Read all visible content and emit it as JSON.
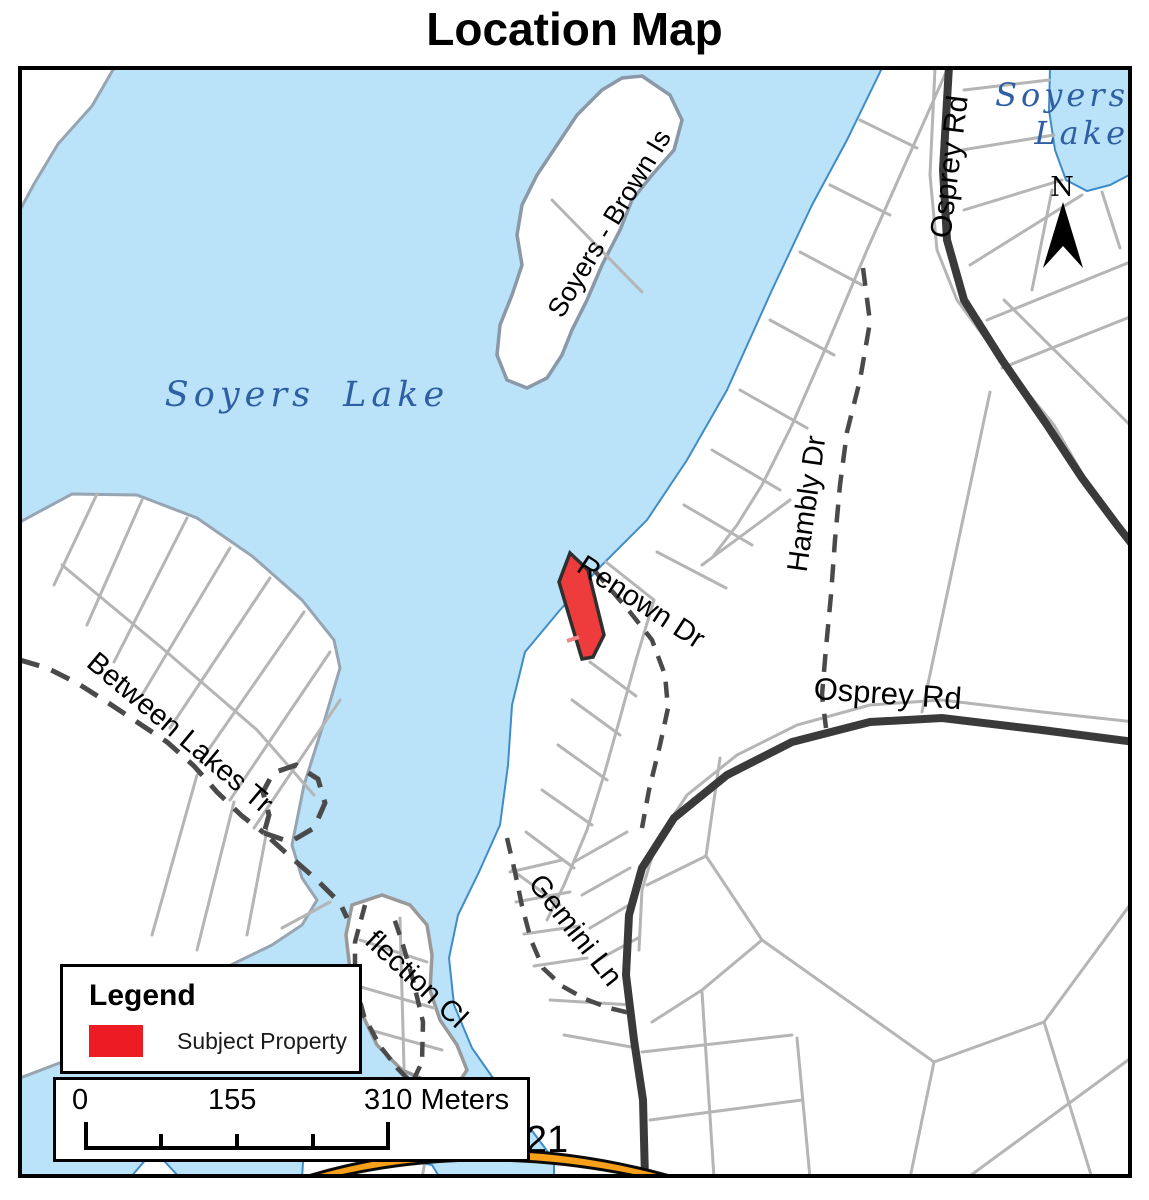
{
  "title": "Location Map",
  "map_labels": {
    "lake_main": "Soyers Lake",
    "lake_tr_line1": "Soyers",
    "lake_tr_line2": "Lake",
    "island": "Soyers - Brown Is",
    "road_renown": "Renown Dr",
    "road_hambly": "Hambly Dr",
    "road_osprey_top": "Osprey Rd",
    "road_osprey_mid": "Osprey Rd",
    "road_between_lakes": "Between Lakes Tr",
    "road_gemini": "Gemini Ln",
    "road_reflection": "flection Cl",
    "highway_21": "21",
    "north": "N"
  },
  "legend": {
    "title": "Legend",
    "items": [
      {
        "label": "Subject Property",
        "color": "#ED1C24"
      }
    ]
  },
  "scale_bar": {
    "start": "0",
    "mid": "155",
    "end": "310 Meters"
  },
  "colors": {
    "water": "#BAE2F8",
    "water_outline": "#3F8CC9",
    "land": "#FFFFFF",
    "land_edge_gray": "#97A5B2",
    "parcel_line": "#B5B5B5",
    "road_major": "#3A3A3A",
    "road_dashed": "#4A4A4A",
    "subject_property_fill": "#EE3B3B",
    "subject_property_outline": "#2F2F2F",
    "highway_orange": "#F9A01B",
    "lake_label_blue": "#2E5FA3"
  }
}
